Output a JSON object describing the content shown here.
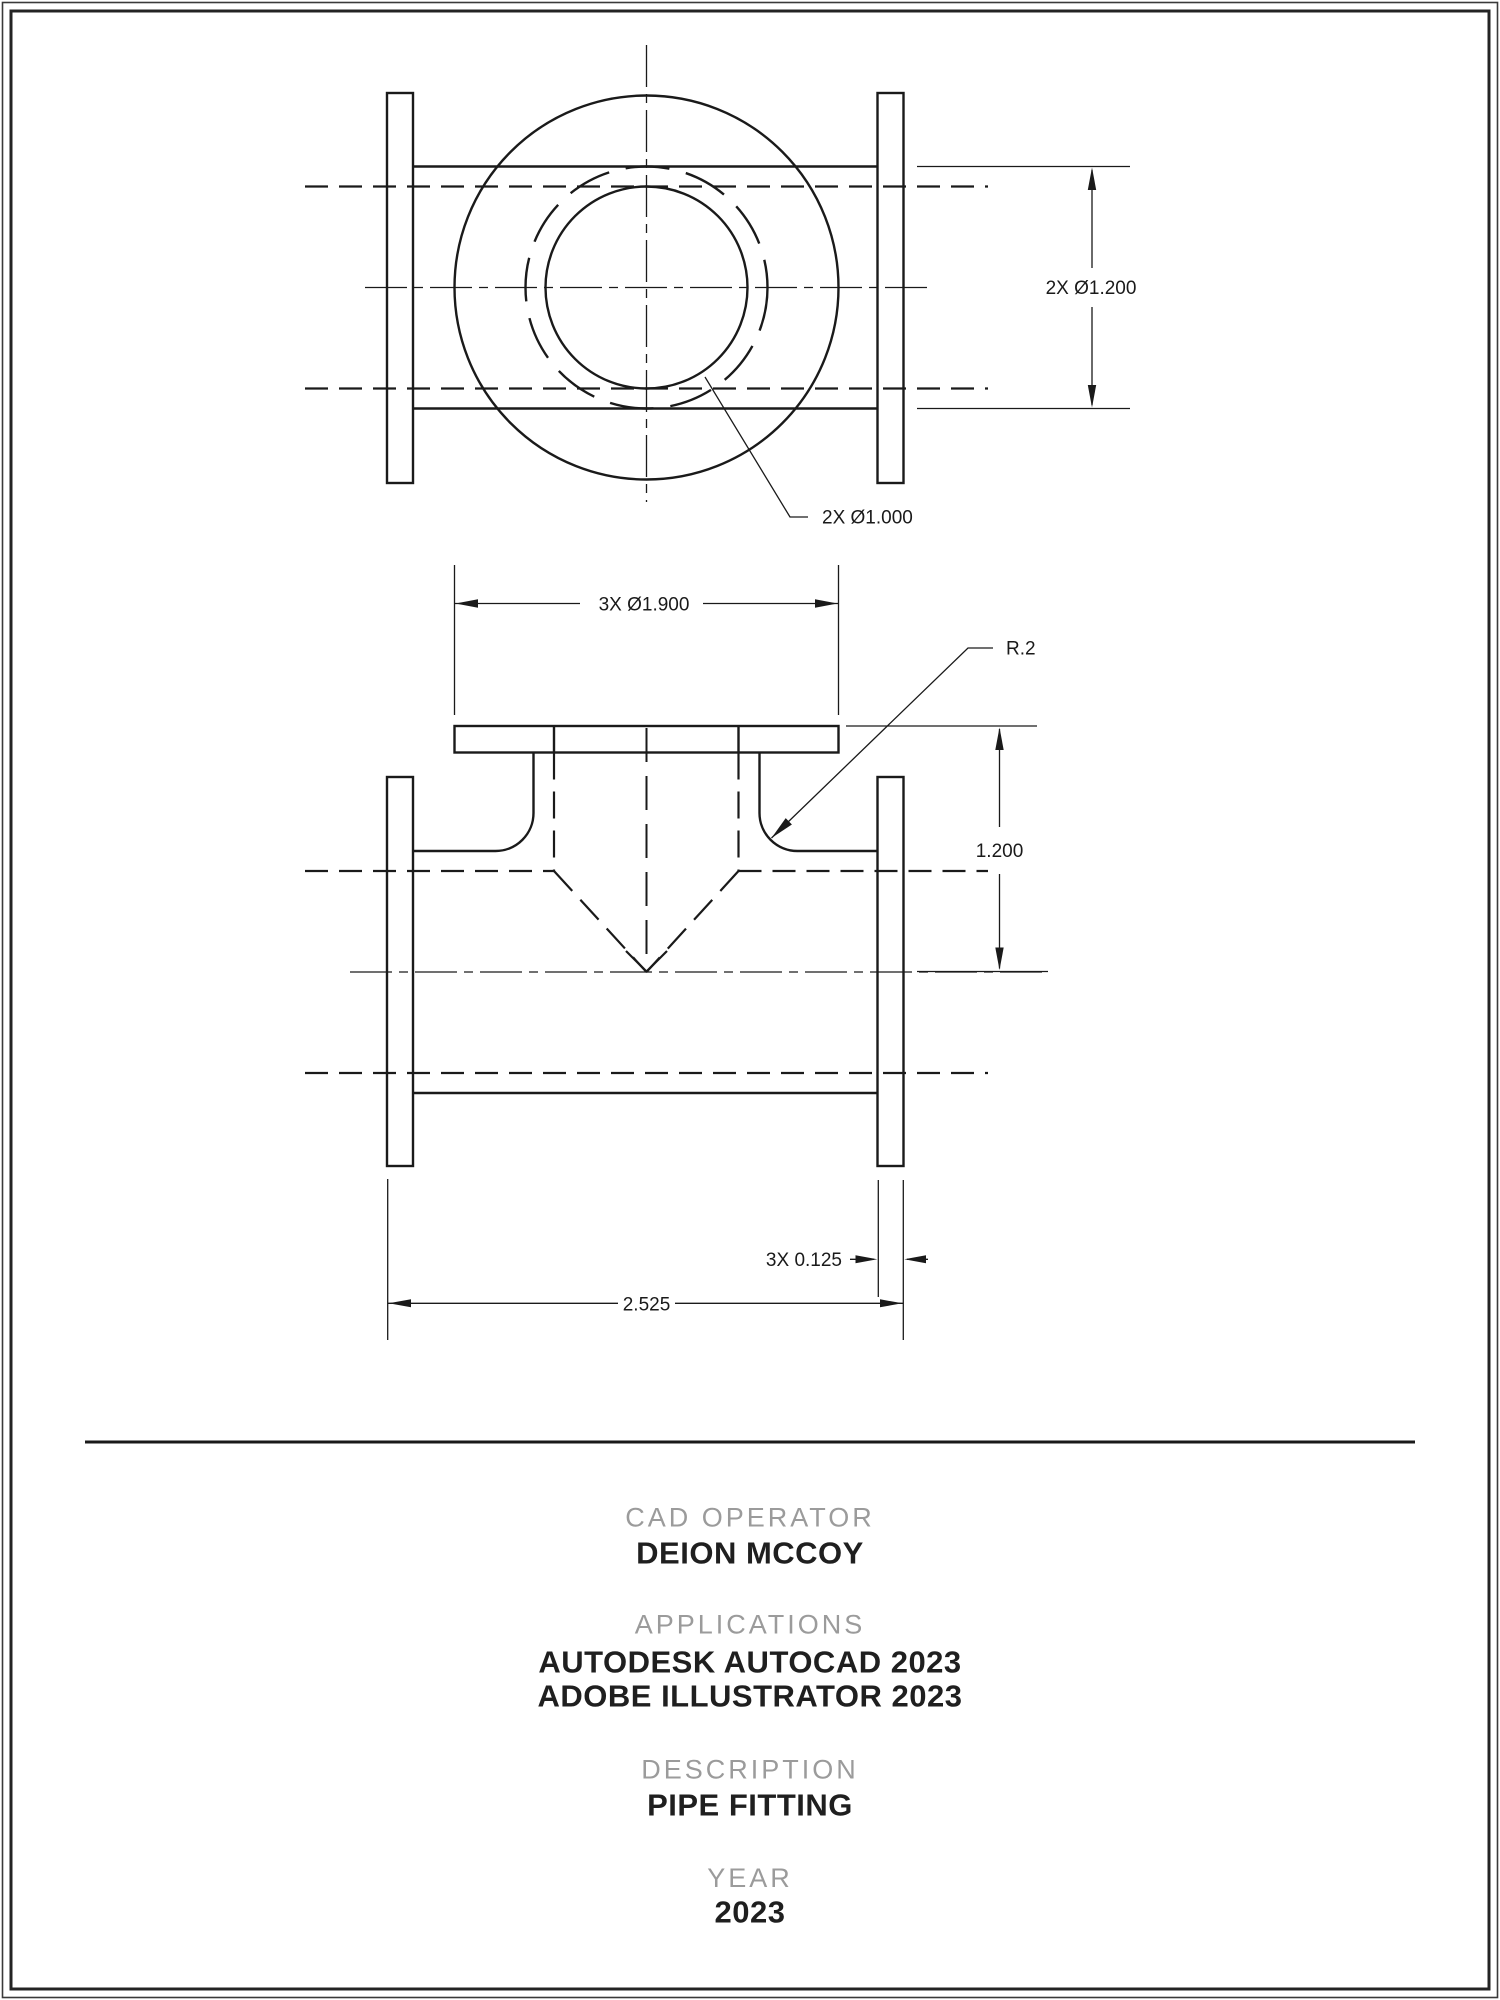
{
  "page": {
    "background": "#ffffff",
    "line_color": "#1a1a1a",
    "label_color": "#9b9b9b"
  },
  "dimensions": {
    "pipe_od": "2X Ø1.200",
    "pipe_bore": "2X Ø1.000",
    "flange_diameter": "3X Ø1.900",
    "fillet_radius": "R.2",
    "branch_length": "1.200",
    "flange_thickness": "3X 0.125",
    "overall_width": "2.525"
  },
  "title_block": {
    "operator_label": "CAD OPERATOR",
    "operator_value": "DEION MCCOY",
    "applications_label": "APPLICATIONS",
    "applications": [
      "AUTODESK AUTOCAD 2023",
      "ADOBE ILLUSTRATOR 2023"
    ],
    "description_label": "DESCRIPTION",
    "description_value": "PIPE FITTING",
    "year_label": "YEAR",
    "year_value": "2023"
  }
}
